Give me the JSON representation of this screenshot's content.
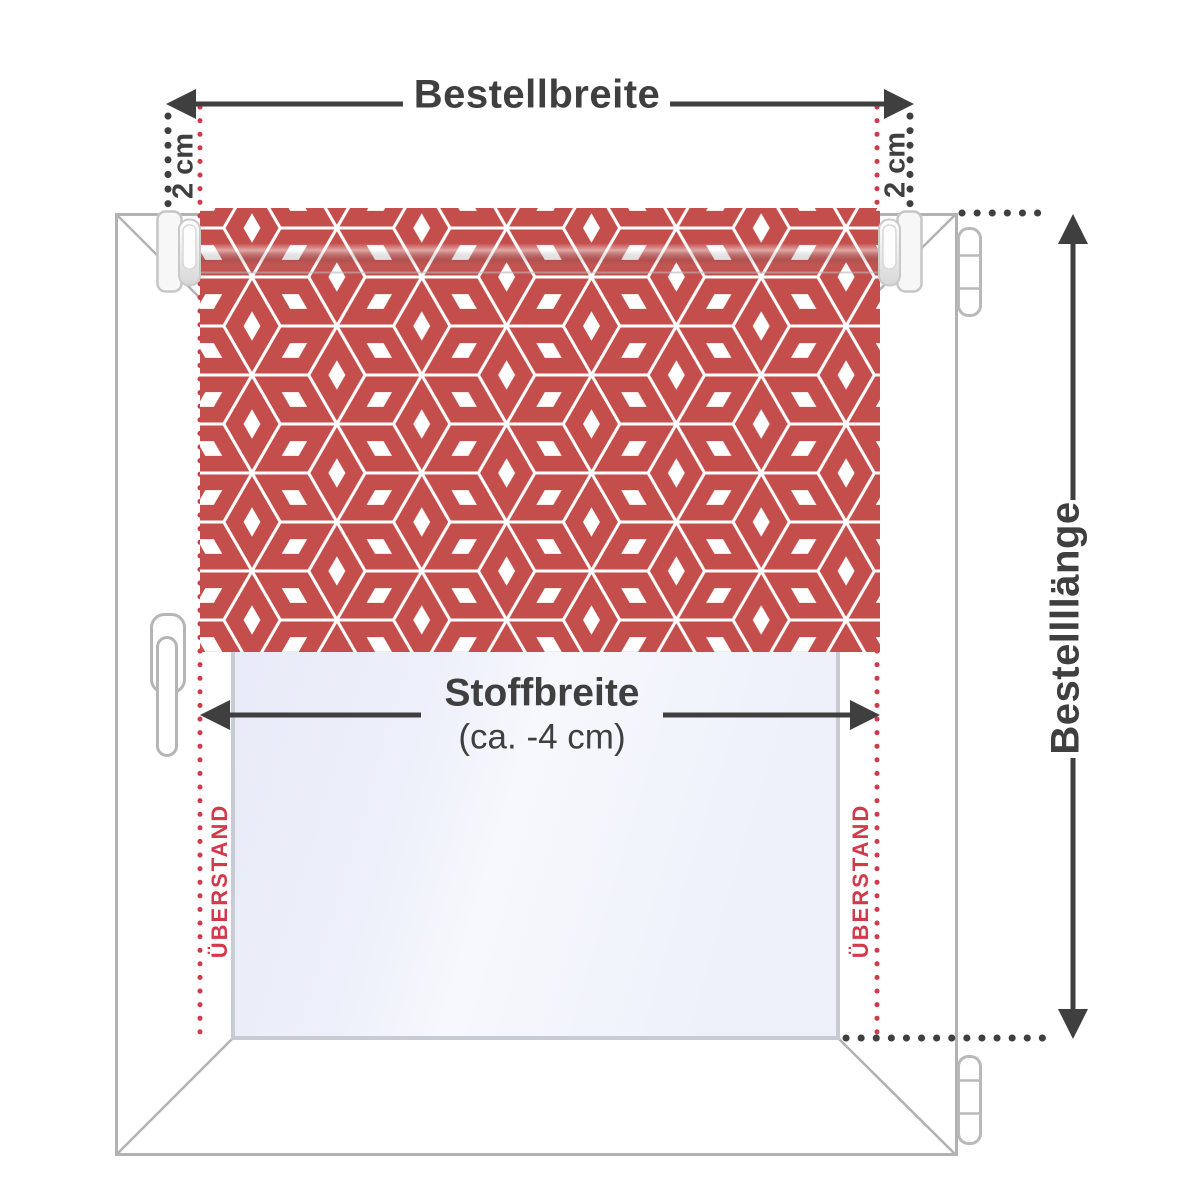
{
  "diagram": {
    "top": {
      "width_label": "Bestellbreite",
      "offset_left": "2 cm",
      "offset_right": "2 cm"
    },
    "middle": {
      "fabric_width_label": "Stoffbreite",
      "fabric_width_note": "(ca. -4 cm)"
    },
    "right": {
      "length_label": "Bestellllänge"
    },
    "overhang": {
      "left": "ÜBERSTAND",
      "right": "ÜBERSTAND"
    },
    "colors": {
      "pattern_red": "#c44e4b",
      "accent_red": "#d2394b",
      "measure_dark": "#3f3f3f",
      "frame_gray": "#b2b2b2",
      "glass_tint": "#e9ecf8"
    }
  }
}
